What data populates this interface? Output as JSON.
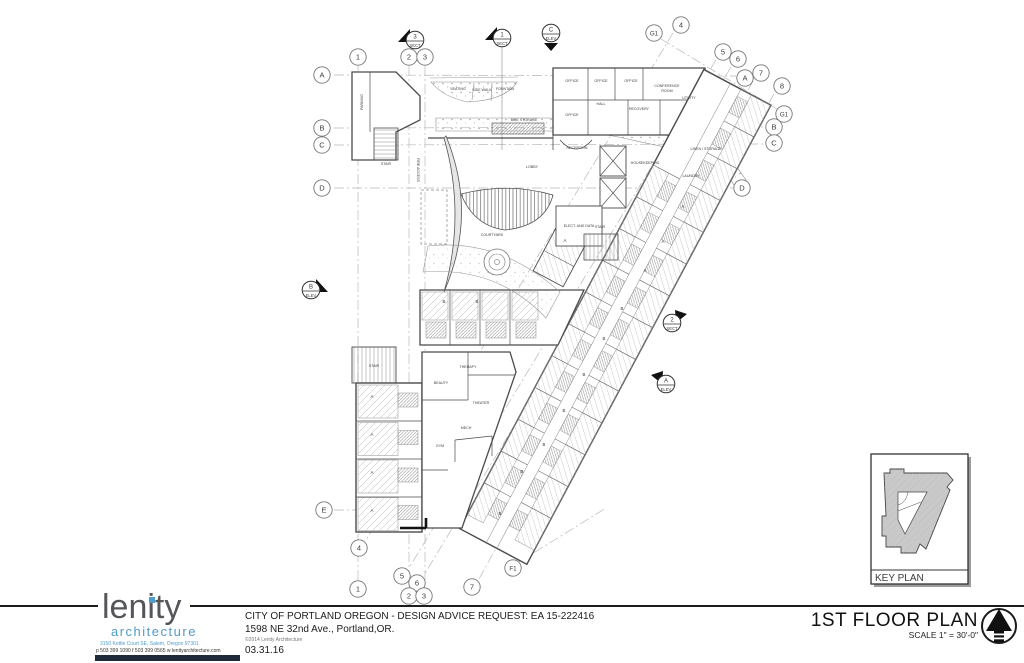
{
  "title_block": {
    "project_line1": "CITY OF PORTLAND OREGON  -  DESIGN ADVICE REQUEST: EA 15-222416",
    "address_line": "1598 NE 32nd Ave., Portland,OR.",
    "copyright": "©2014 Lenity Architecture",
    "date": "03.31.16"
  },
  "logo": {
    "word": "lenity",
    "sub": "architecture",
    "address": "3150 Kettle Court SE, Salem, Oregon 97301",
    "contact": "p 503 399 1090    f 503 399 0565    w lenityarchitecture.com",
    "accent_color": "#4f9cc8",
    "text_color": "#54565a"
  },
  "drawing": {
    "title": "1ST FLOOR PLAN",
    "scale": "SCALE 1\" = 30'-0\"",
    "key_plan_label": "KEY PLAN"
  },
  "plan": {
    "grid_bubbles": [
      {
        "t": "1",
        "x": 358,
        "y": 57
      },
      {
        "t": "2",
        "x": 409,
        "y": 57
      },
      {
        "t": "3",
        "x": 425,
        "y": 57
      },
      {
        "t": "G1",
        "x": 654,
        "y": 33
      },
      {
        "t": "4",
        "x": 681,
        "y": 25
      },
      {
        "t": "5",
        "x": 723,
        "y": 52
      },
      {
        "t": "6",
        "x": 738,
        "y": 59
      },
      {
        "t": "A",
        "x": 745,
        "y": 78
      },
      {
        "t": "7",
        "x": 761,
        "y": 73
      },
      {
        "t": "8",
        "x": 782,
        "y": 86
      },
      {
        "t": "G1",
        "x": 784,
        "y": 114
      },
      {
        "t": "B",
        "x": 774,
        "y": 127
      },
      {
        "t": "C",
        "x": 774,
        "y": 143
      },
      {
        "t": "A",
        "x": 322,
        "y": 75
      },
      {
        "t": "B",
        "x": 322,
        "y": 128
      },
      {
        "t": "C",
        "x": 322,
        "y": 145
      },
      {
        "t": "D",
        "x": 322,
        "y": 188
      },
      {
        "t": "E",
        "x": 324,
        "y": 510
      },
      {
        "t": "D",
        "x": 742,
        "y": 188
      },
      {
        "t": "4",
        "x": 359,
        "y": 548
      },
      {
        "t": "1",
        "x": 358,
        "y": 589
      },
      {
        "t": "5",
        "x": 402,
        "y": 576
      },
      {
        "t": "6",
        "x": 417,
        "y": 583
      },
      {
        "t": "2",
        "x": 409,
        "y": 596
      },
      {
        "t": "3",
        "x": 424,
        "y": 596
      },
      {
        "t": "7",
        "x": 472,
        "y": 587
      },
      {
        "t": "F1",
        "x": 513,
        "y": 568
      }
    ],
    "markers": [
      {
        "num": "3",
        "type": "SECT",
        "x": 415,
        "y": 40,
        "dir": "left"
      },
      {
        "num": "1",
        "type": "SECT",
        "x": 502,
        "y": 38,
        "dir": "left"
      },
      {
        "num": "C",
        "type": "ELEV",
        "x": 551,
        "y": 33,
        "dir": "down"
      },
      {
        "num": "B",
        "type": "ELEV",
        "x": 311,
        "y": 290,
        "dir": "right"
      },
      {
        "num": "2",
        "type": "SECT",
        "x": 672,
        "y": 323,
        "dir": "ur"
      },
      {
        "num": "A",
        "type": "ELEV",
        "x": 666,
        "y": 384,
        "dir": "ul"
      }
    ],
    "room_labels": [
      {
        "text": "OFFICE",
        "x": 572,
        "y": 82
      },
      {
        "text": "OFFICE",
        "x": 601,
        "y": 82
      },
      {
        "text": "OFFICE",
        "x": 631,
        "y": 82
      },
      {
        "text": "CONFERENCE",
        "x": 667,
        "y": 87
      },
      {
        "text": "ROOM",
        "x": 667,
        "y": 92
      },
      {
        "text": "UTILITY",
        "x": 689,
        "y": 99
      },
      {
        "text": "OFFICE",
        "x": 572,
        "y": 116
      },
      {
        "text": "HALL",
        "x": 601,
        "y": 105
      },
      {
        "text": "RECOVERY",
        "x": 639,
        "y": 110
      },
      {
        "text": "LINEN / STORAGE",
        "x": 706,
        "y": 150
      },
      {
        "text": "HOUSEKEEPING",
        "x": 645,
        "y": 164
      },
      {
        "text": "LAUNDRY",
        "x": 691,
        "y": 177
      },
      {
        "text": "STAIR",
        "x": 600,
        "y": 228
      },
      {
        "text": "ELECT. AND DATA",
        "x": 579,
        "y": 227
      },
      {
        "text": "LOBBY",
        "x": 532,
        "y": 168
      },
      {
        "text": "RECEPTION",
        "x": 577,
        "y": 149
      },
      {
        "text": "BIKE STORAGE",
        "x": 524,
        "y": 121
      },
      {
        "text": "SEATING",
        "x": 458,
        "y": 90
      },
      {
        "text": "SIDE WALK",
        "x": 482,
        "y": 91
      },
      {
        "text": "FOUNTAIN",
        "x": 505,
        "y": 90
      },
      {
        "text": "COURTYARD",
        "x": 492,
        "y": 236
      },
      {
        "text": "BEAUTY",
        "x": 441,
        "y": 384
      },
      {
        "text": "THERAPY",
        "x": 468,
        "y": 368
      },
      {
        "text": "THEATER",
        "x": 481,
        "y": 404
      },
      {
        "text": "MECH",
        "x": 466,
        "y": 429
      },
      {
        "text": "GYM",
        "x": 440,
        "y": 447
      },
      {
        "text": "STAIR",
        "x": 386,
        "y": 165
      },
      {
        "text": "STAIR",
        "x": 374,
        "y": 367
      },
      {
        "text": "PARKING",
        "x": 363,
        "y": 102,
        "r": -90
      },
      {
        "text": "FIRE ACCESS",
        "x": 417,
        "y": 170,
        "r": 90
      }
    ],
    "unit_labels": [
      {
        "t": "A",
        "x": 683,
        "y": 208
      },
      {
        "t": "A",
        "x": 663,
        "y": 243
      },
      {
        "t": "A",
        "x": 645,
        "y": 272
      },
      {
        "t": "A",
        "x": 565,
        "y": 242
      },
      {
        "t": "B",
        "x": 622,
        "y": 310
      },
      {
        "t": "B",
        "x": 604,
        "y": 340
      },
      {
        "t": "B",
        "x": 584,
        "y": 376
      },
      {
        "t": "B",
        "x": 564,
        "y": 412
      },
      {
        "t": "B",
        "x": 544,
        "y": 446
      },
      {
        "t": "B",
        "x": 522,
        "y": 473
      },
      {
        "t": "B",
        "x": 500,
        "y": 515
      },
      {
        "t": "B",
        "x": 444,
        "y": 303
      },
      {
        "t": "B",
        "x": 477,
        "y": 303
      },
      {
        "t": "A",
        "x": 372,
        "y": 398
      },
      {
        "t": "A",
        "x": 372,
        "y": 436
      },
      {
        "t": "A",
        "x": 372,
        "y": 474
      },
      {
        "t": "A",
        "x": 372,
        "y": 512
      }
    ]
  }
}
